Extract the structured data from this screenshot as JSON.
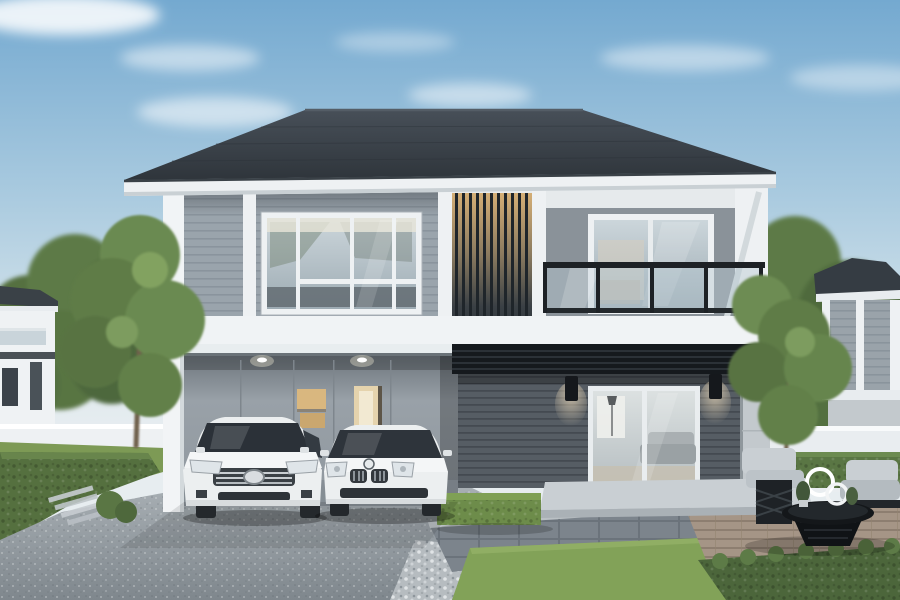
{
  "image": {
    "type": "photorealistic architectural exterior rendering",
    "subject": "Modern two-story detached house with double carport and two white sedans",
    "setting": "Suburban plot in daytime under a clear blue sky with thin clouds, neighboring houses at both edges",
    "elements": {
      "sky": "blue gradient sky with soft white clouds",
      "main_house": {
        "roof": "dark charcoal hip roof with white fascia board",
        "upper_floor": {
          "left_wing": "light gray horizontal lap siding with white corner posts",
          "picture_window": "large white-framed multi-pane window showing kitchen interior",
          "louver_screen": "full-height vertical wood louvers with warm interior light glowing through the top",
          "balcony": {
            "wall": "plain gray render wall",
            "sliding_door": "white-framed glass sliding door",
            "railing": "black metal railing with tinted glass panels",
            "corner": "white structural corner with diagonal strut"
          }
        },
        "lower_floor": {
          "carport": "double recessed carport with gray panel wall, two recessed ceiling downlights and two warm-lit openings",
          "dark_wall": "charcoal horizontal siding wall with two black wall sconces",
          "living_room_door": "white-framed glass double door showing sofa, lamp and coffee table",
          "awning": "black slatted steel awning above the lower right wall",
          "terrace": "light concrete terrace slab with step"
        }
      },
      "vehicles": [
        {
          "description": "white/silver sedan with chrome bar grille and oval emblem",
          "position": "left carport bay"
        },
        {
          "description": "white sedan with twin kidney grilles and roundel emblem",
          "position": "right carport bay"
        }
      ],
      "landscaping": {
        "driveway": "speckled gray concrete driveway",
        "left_lawn": "green lawn strip with clipped hedge, stepping slats and small shrub",
        "box_hedge": "rectangular trimmed hedge block near terrace",
        "center_lawn": "bright mown grass panel bordered by white gravel and dark pavers",
        "deck": "wood-tone deck at right with seating area",
        "bottom_right_hedge": "dense leafy hedge in the right foreground",
        "trees": "leafy green trees flanking both sides of the house",
        "perimeter_fence": "low white boundary wall on both sides"
      },
      "outdoor_furniture": {
        "chairs": "two gray cushioned lounge chairs with black lattice frames",
        "table": "round black woven coffee table",
        "decor": "white ring sculptures and small potted plants"
      },
      "neighbor_houses": [
        {
          "position": "far left",
          "description": "white two-story house with dark roof and balcony"
        },
        {
          "position": "far right",
          "description": "gray-sided two-story house with dark hip roof and white columns"
        }
      ]
    },
    "palette": {
      "sky_top": "#74a9d0",
      "sky_horizon": "#e7edf0",
      "cloud_white": "#ffffff",
      "roof_dark": "#363d45",
      "fascia_white": "#eef1f3",
      "siding_upper": "#9aa4ac",
      "wall_right_gray": "#8a9299",
      "wall_lower_dark": "#565d64",
      "carport_wall": "#969ea5",
      "louver_glow": "#d8b177",
      "railing_black": "#1d2125",
      "awning_black": "#15191d",
      "glass_tint": "#c3ced4",
      "warm_light": "#d9b77f",
      "driveway_gray": "#98a0a6",
      "grass_green": "#7d9a55",
      "grass_bright": "#82a258",
      "hedge_green": "#55703f",
      "tree_green": "#66854d",
      "fence_white": "#e9edf0",
      "concrete": "#c9cfd3",
      "deck_wood": "#a09081",
      "car_white": "#eceff0",
      "furniture_gray": "#c6ccd0",
      "furniture_black": "#171b1e"
    }
  }
}
